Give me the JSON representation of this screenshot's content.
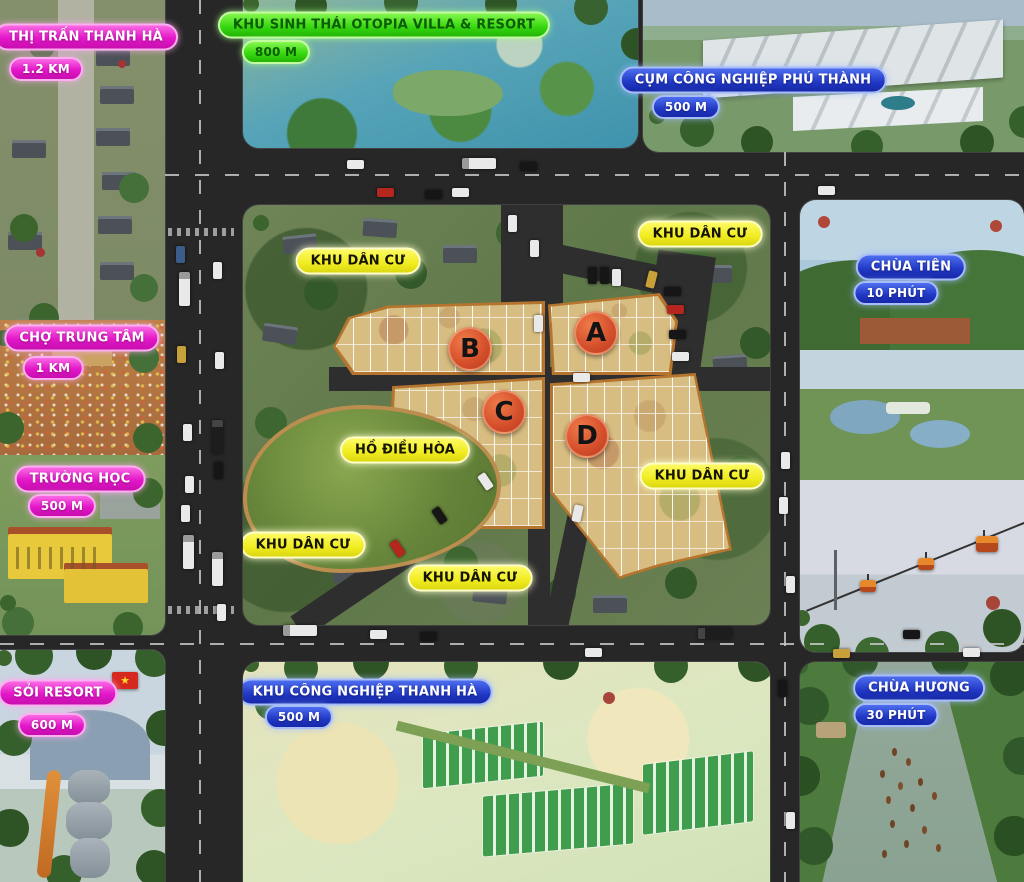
{
  "landmarks": {
    "town": {
      "label": "THỊ TRẤN THANH HÀ",
      "distance": "1.2 KM"
    },
    "otopia": {
      "label": "KHU SINH THÁI OTOPIA VILLA & RESORT",
      "distance": "800 M"
    },
    "phu_thanh_iz": {
      "label": "CỤM CÔNG NGHIỆP PHÚ THÀNH",
      "distance": "500 M"
    },
    "market": {
      "label": "CHỢ TRUNG TÂM",
      "distance": "1 KM"
    },
    "school": {
      "label": "TRƯỜNG HỌC",
      "distance": "500 M"
    },
    "chua_tien": {
      "label": "CHÙA TIÊN",
      "distance": "10 PHÚT"
    },
    "soi_resort": {
      "label": "SỎI RESORT",
      "distance": "600 M"
    },
    "thanh_ha_iz": {
      "label": "KHU CÔNG NGHIỆP THANH HÀ",
      "distance": "500 M"
    },
    "chua_huong": {
      "label": "CHÙA HƯƠNG",
      "distance": "30 PHÚT"
    }
  },
  "map": {
    "residential_label": "KHU DÂN CƯ",
    "lake_label": "HỒ ĐIỀU HÒA",
    "plots": [
      {
        "id": "A"
      },
      {
        "id": "B"
      },
      {
        "id": "C"
      },
      {
        "id": "D"
      }
    ]
  },
  "icons": {
    "vietnam_flag_star": "★"
  },
  "colors": {
    "label_magenta": "#e417c9",
    "label_green": "#35d60f",
    "label_blue": "#2138c4",
    "label_yellow": "#f0ec20",
    "plot_marker": "#d34e2b",
    "plot_ground": "#d7bd81",
    "lake_green": "#66853a",
    "road_asphalt": "#272727"
  }
}
